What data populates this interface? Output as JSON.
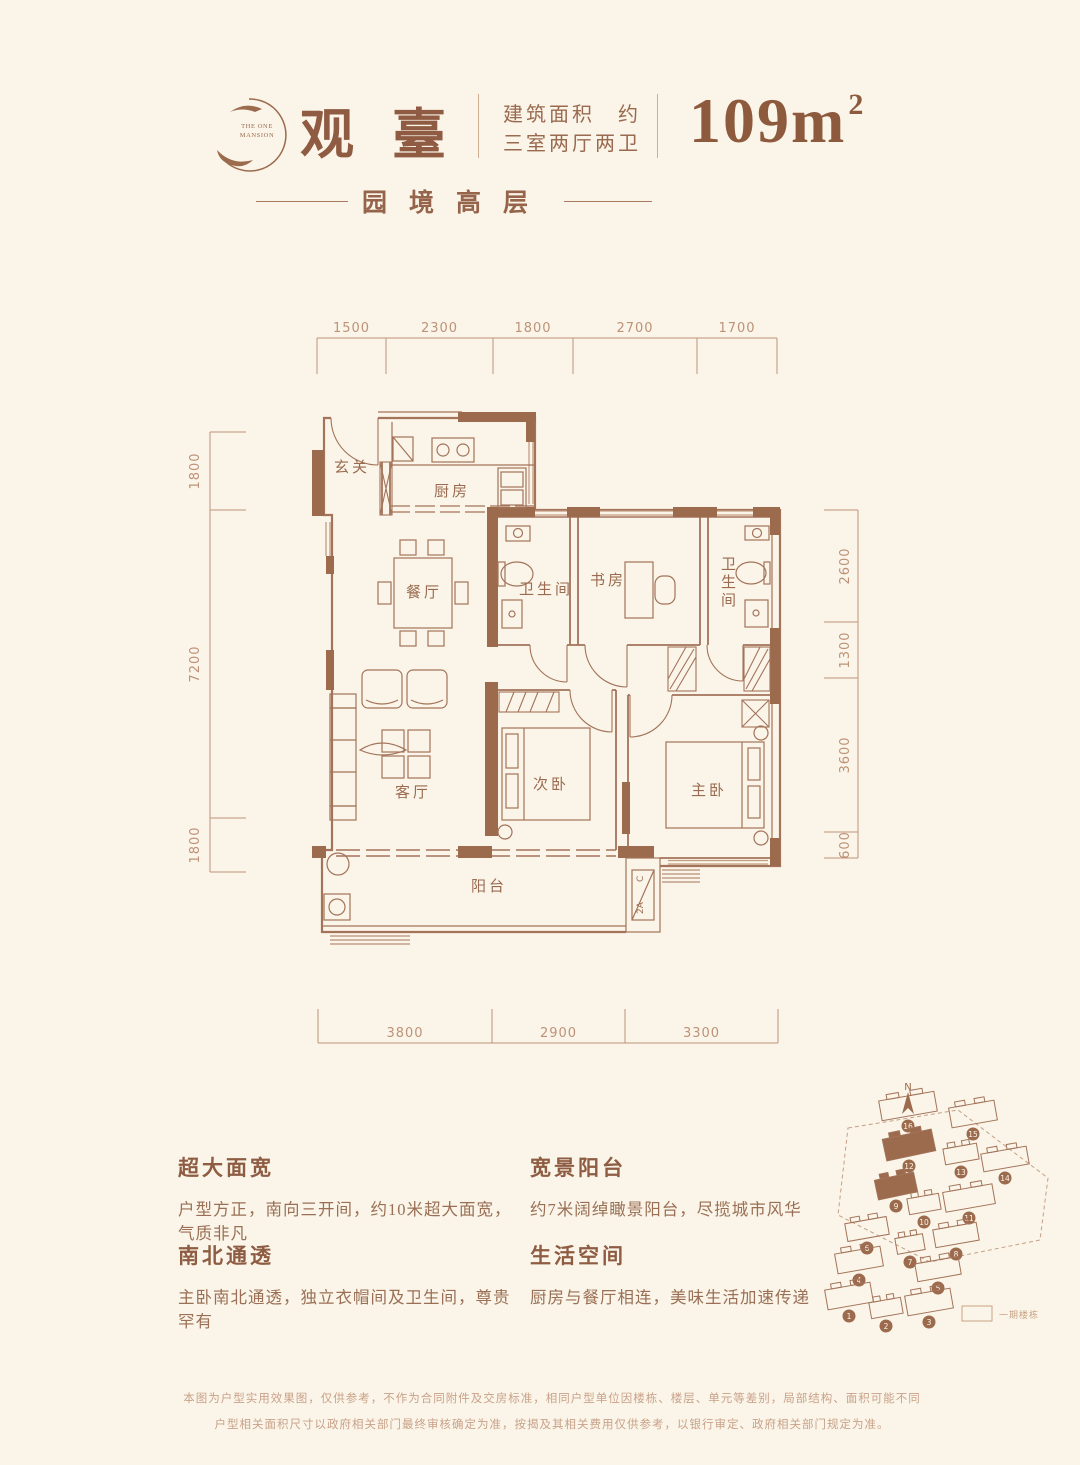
{
  "header": {
    "logo_line1": "THE ONE",
    "logo_line2": "MANSION",
    "title": "观臺",
    "spec_line1": "建筑面积　约",
    "spec_line2": "三室两厅两卫",
    "area_value": "109m",
    "area_sup": "2",
    "subtitle": "园境高层"
  },
  "plan": {
    "rooms": {
      "entry": "玄关",
      "kitchen": "厨房",
      "dining": "餐厅",
      "bath1": "卫生间",
      "study": "书房",
      "bath2": "卫生间",
      "living": "客厅",
      "bed2": "次卧",
      "master": "主卧",
      "balcony": "阳台"
    },
    "ac": {
      "a": "2A",
      "b": "C"
    },
    "dims": {
      "top": [
        "1500",
        "2300",
        "1800",
        "2700",
        "1700"
      ],
      "left": [
        "1800",
        "7200",
        "1800"
      ],
      "right": [
        "2600",
        "1300",
        "3600",
        "600"
      ],
      "bottom": [
        "3800",
        "2900",
        "3300"
      ]
    }
  },
  "features": [
    {
      "title": "超大面宽",
      "body": "户型方正，南向三开间，约10米超大面宽，气质非凡"
    },
    {
      "title": "南北通透",
      "body": "主卧南北通透，独立衣帽间及卫生间，尊贵罕有"
    },
    {
      "title": "宽景阳台",
      "body": "约7米阔绰瞰景阳台，尽揽城市风华"
    },
    {
      "title": "生活空间",
      "body": "厨房与餐厅相连，美味生活加速传递"
    }
  ],
  "siteplan": {
    "north_label": "N",
    "legend_label": "一期楼栋",
    "buildings": [
      {
        "n": "16",
        "x": 880,
        "y": 1096,
        "w": 56,
        "h": 20,
        "r": -10,
        "hl": false
      },
      {
        "n": "15",
        "x": 950,
        "y": 1104,
        "w": 46,
        "h": 20,
        "r": -10,
        "hl": false
      },
      {
        "n": "12",
        "x": 884,
        "y": 1134,
        "w": 50,
        "h": 22,
        "r": -12,
        "hl": true
      },
      {
        "n": "13",
        "x": 944,
        "y": 1146,
        "w": 34,
        "h": 16,
        "r": -10,
        "hl": false
      },
      {
        "n": "14",
        "x": 982,
        "y": 1150,
        "w": 46,
        "h": 18,
        "r": -10,
        "hl": false
      },
      {
        "n": "9",
        "x": 876,
        "y": 1176,
        "w": 40,
        "h": 20,
        "r": -12,
        "hl": true
      },
      {
        "n": "10",
        "x": 908,
        "y": 1196,
        "w": 32,
        "h": 16,
        "r": -10,
        "hl": false
      },
      {
        "n": "11",
        "x": 944,
        "y": 1188,
        "w": 50,
        "h": 20,
        "r": -10,
        "hl": false
      },
      {
        "n": "6",
        "x": 846,
        "y": 1220,
        "w": 42,
        "h": 18,
        "r": -10,
        "hl": false
      },
      {
        "n": "7",
        "x": 896,
        "y": 1236,
        "w": 28,
        "h": 16,
        "r": -10,
        "hl": false
      },
      {
        "n": "8",
        "x": 934,
        "y": 1226,
        "w": 44,
        "h": 18,
        "r": -10,
        "hl": false
      },
      {
        "n": "4",
        "x": 836,
        "y": 1250,
        "w": 46,
        "h": 20,
        "r": -10,
        "hl": false
      },
      {
        "n": "5",
        "x": 916,
        "y": 1260,
        "w": 44,
        "h": 18,
        "r": -10,
        "hl": false
      },
      {
        "n": "1",
        "x": 826,
        "y": 1286,
        "w": 46,
        "h": 20,
        "r": -10,
        "hl": false
      },
      {
        "n": "2",
        "x": 870,
        "y": 1300,
        "w": 32,
        "h": 16,
        "r": -10,
        "hl": false
      },
      {
        "n": "3",
        "x": 906,
        "y": 1292,
        "w": 46,
        "h": 20,
        "r": -10,
        "hl": false
      }
    ]
  },
  "disclaimer": {
    "line1": "本图为户型实用效果图，仅供参考，不作为合同附件及交房标准，相同户型单位因楼栋、楼层、单元等差别，局部结构、面积可能不同",
    "line2": "户型相关面积尺寸以政府相关部门最终审核确定为准，按揭及其相关费用仅供参考，以银行审定、政府相关部门规定为准。"
  },
  "colors": {
    "background": "#FAF5E8",
    "wall_fill": "#9C6A4D",
    "line": "#A3735A",
    "dim": "#BE9278",
    "heading": "#8E5C42",
    "muted": "#C9A284"
  }
}
